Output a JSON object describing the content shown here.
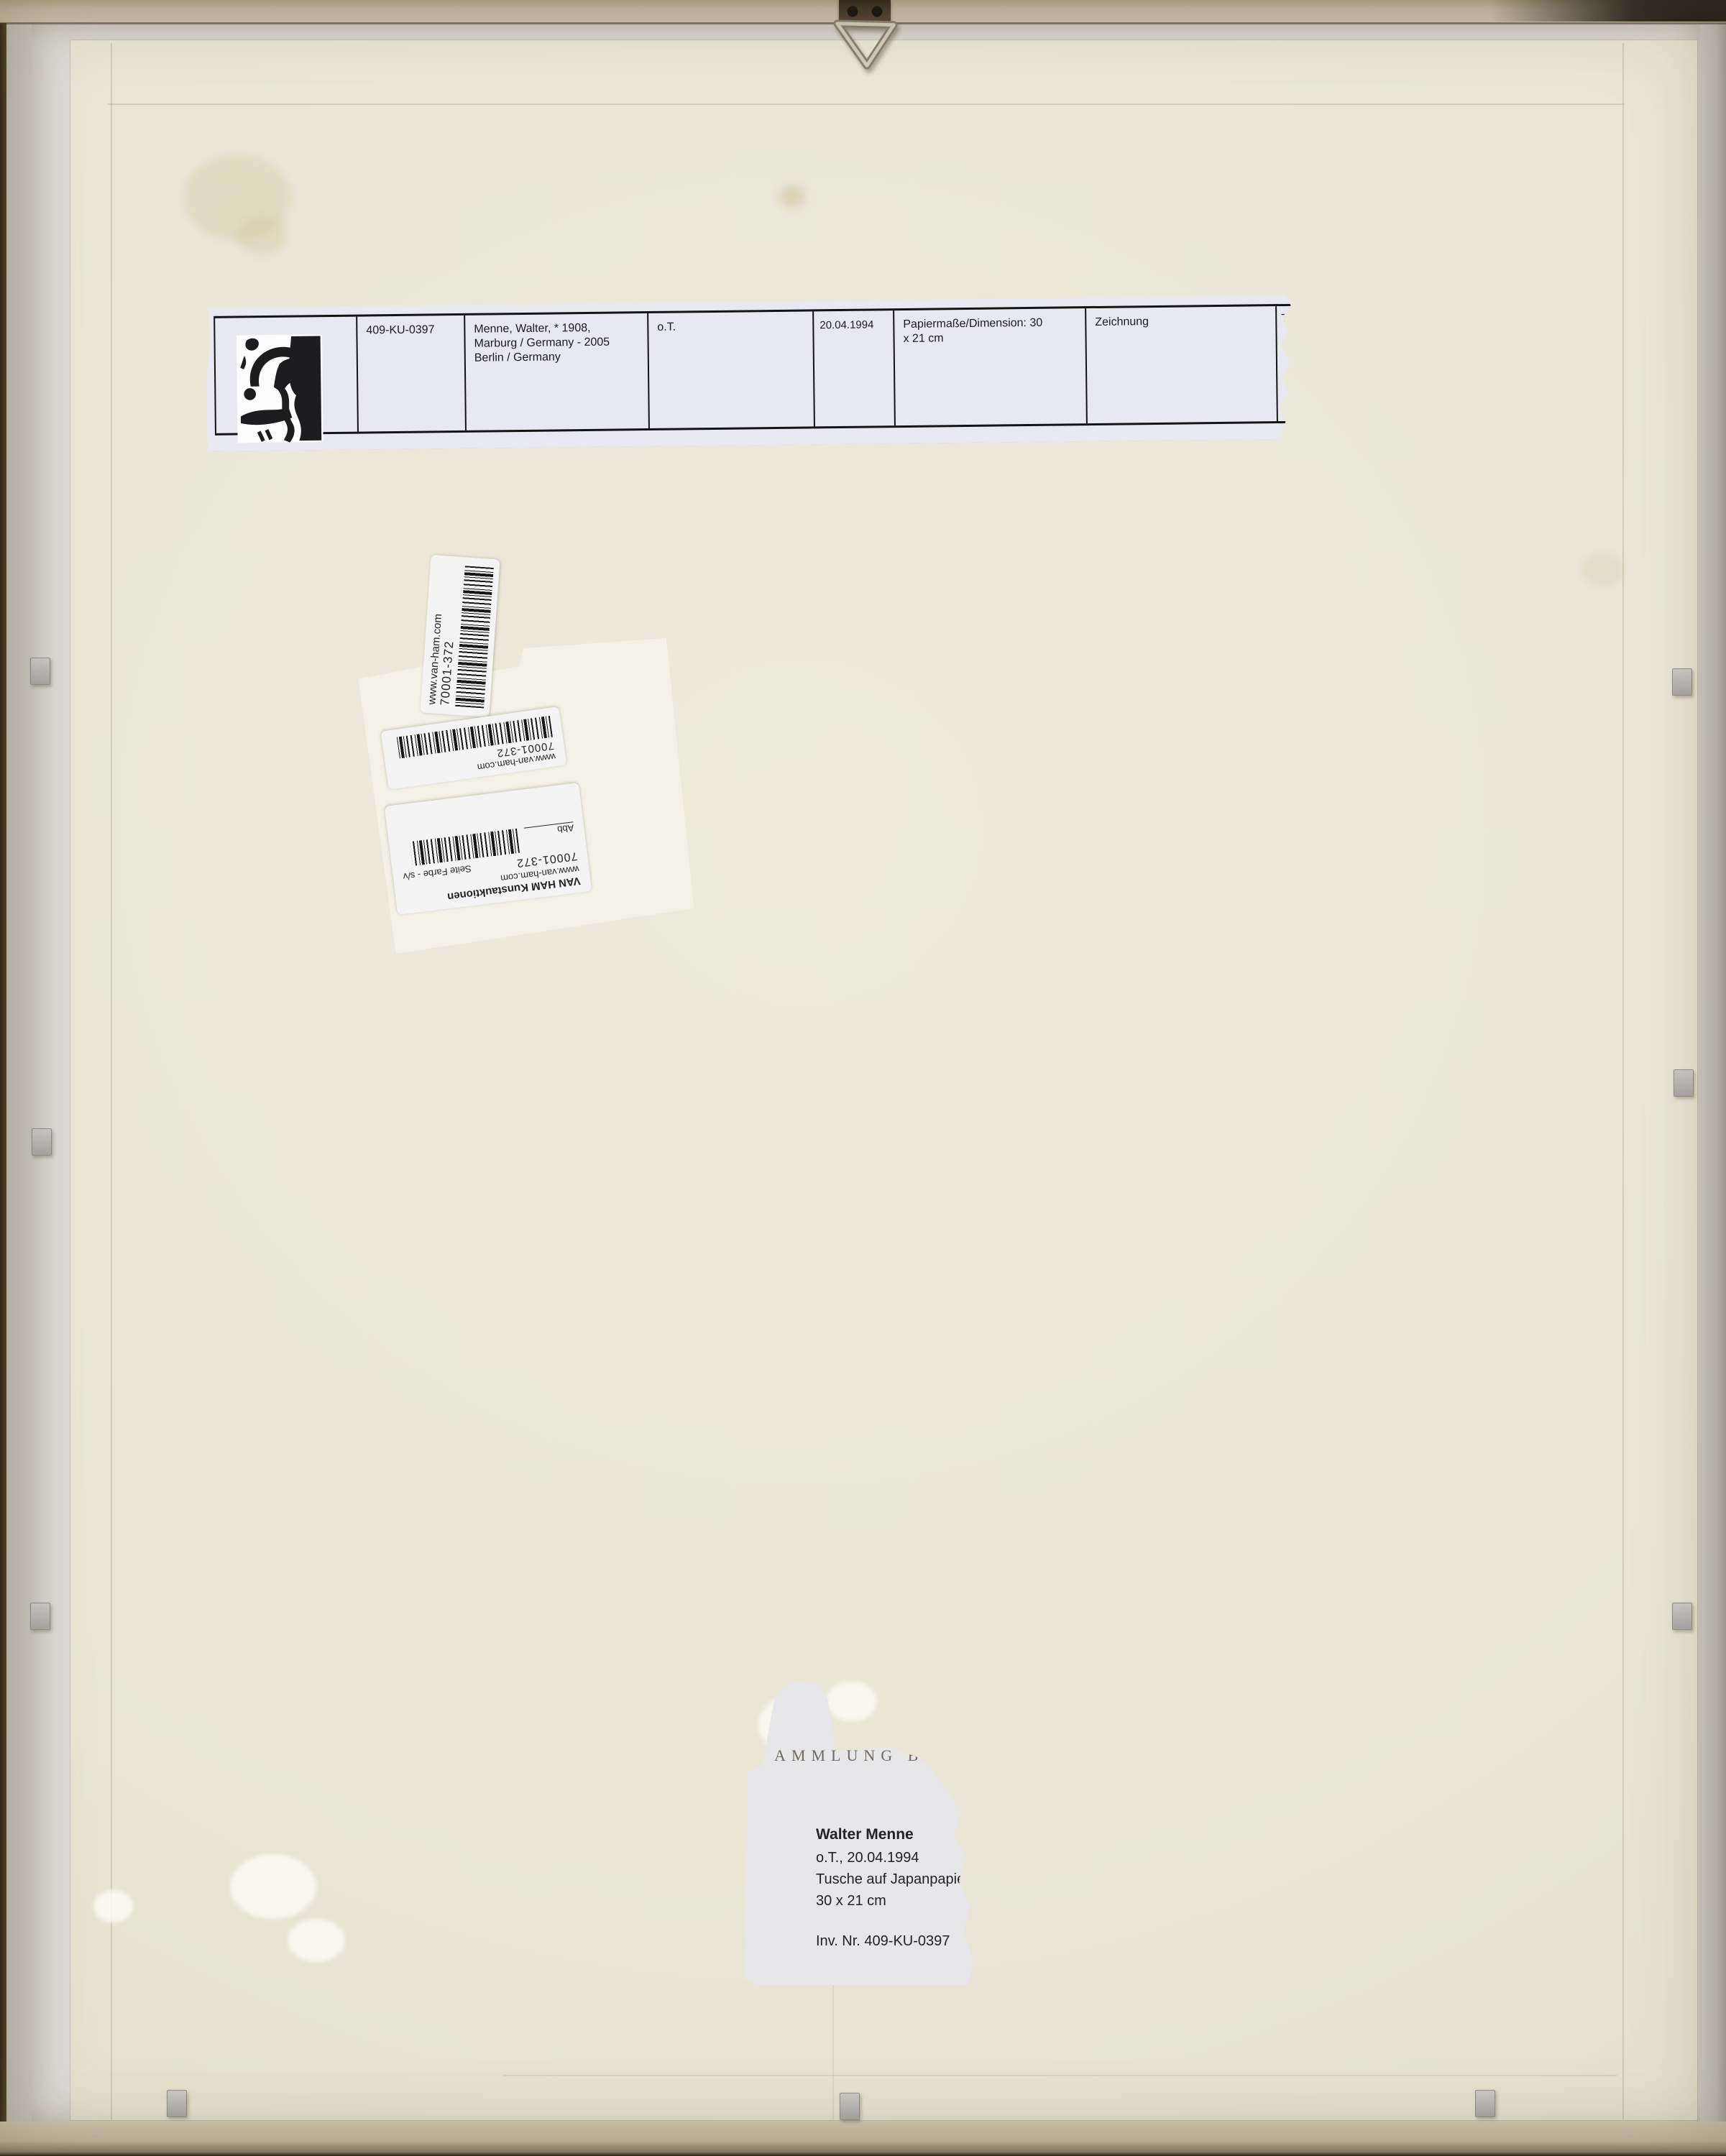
{
  "strip": {
    "cells": [
      "409-KU-0397",
      "Menne, Walter, * 1908,\nMarburg / Germany - 2005\nBerlin / Germany",
      "o.T.",
      "20.04.1994",
      "Papiermaße/Dimension: 30\nx 21 cm",
      "Zeichnung",
      "T"
    ]
  },
  "barcode_labels": {
    "website": "www.van-ham.com",
    "number": "70001-372",
    "company": "VAN HAM Kunstauktionen",
    "fig_label": "Abb",
    "page_color_label": "Seite Farbe - s/v"
  },
  "collection_label": {
    "letterhead": "AMMLUNG B",
    "artist": "Walter Menne",
    "title_date": "o.T., 20.04.1994",
    "technique": "Tusche auf Japanpapier",
    "dimensions": "30 x 21 cm",
    "inventory": "Inv. Nr. 409-KU-0397"
  },
  "colors": {
    "backing_board": "#e9e6d6",
    "frame_gray": "#cbc8c0",
    "frame_tan": "#c9bda6",
    "strip_label": "#e8e8f0",
    "barcode_label": "#f4f4f5",
    "collection_label": "#e7e6e9",
    "hardware_bronze": "#46392a"
  }
}
